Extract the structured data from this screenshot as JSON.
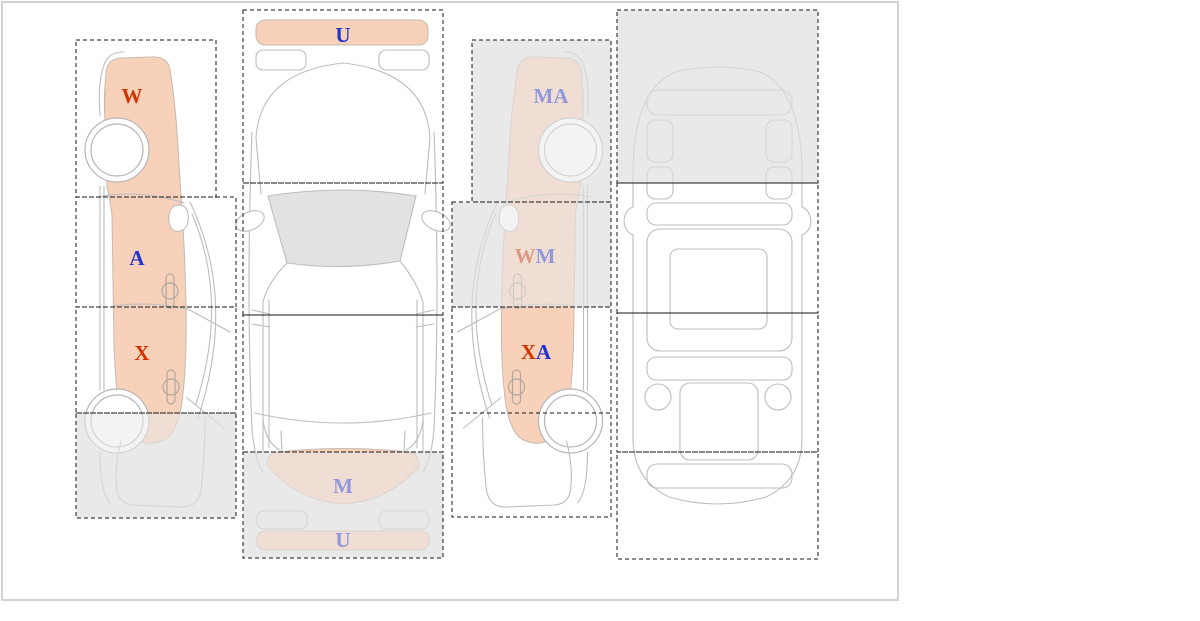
{
  "colors": {
    "red": "#d13300",
    "blue": "#2433cc",
    "highlight": "#f8d1ba",
    "zone_gray": "#e9e9e9",
    "outline_gray": "#bdbdbd",
    "glass_gray": "#e2e2e2",
    "dash_black": "#161616",
    "frame_border": "#d2d2d2"
  },
  "labels": {
    "left_fender": "W",
    "left_front_door": "A",
    "left_rear_door": "X",
    "top_front_bumper": "U",
    "top_rear_window": "M",
    "top_rear_bumper": "U",
    "right_fender": "MA",
    "right_front_door_1": "W",
    "right_front_door_2": "M",
    "right_rear_door_1": "X",
    "right_rear_door_2": "A"
  },
  "views": {
    "left_side": {
      "zones": [
        {
          "id": "fender",
          "label": "W",
          "label_color": "red",
          "shaded": false
        },
        {
          "id": "front_door",
          "label": "A",
          "label_color": "blue",
          "shaded": false
        },
        {
          "id": "rear_door",
          "label": "X",
          "label_color": "red",
          "shaded": false
        },
        {
          "id": "rear_quarter",
          "label": "",
          "shaded": true
        }
      ]
    },
    "top": {
      "zones": [
        {
          "id": "front",
          "label": "U",
          "label_color": "blue",
          "shaded": false
        },
        {
          "id": "windshield",
          "label": "",
          "shaded": false
        },
        {
          "id": "cabin",
          "label": "",
          "shaded": false
        },
        {
          "id": "rear",
          "label": "M / U",
          "label_color": "blue",
          "shaded": true
        }
      ]
    },
    "right_side": {
      "zones": [
        {
          "id": "fender",
          "label": "MA",
          "label_color": "blue",
          "shaded": true
        },
        {
          "id": "front_door",
          "label": "WM",
          "label_color": "red+blue",
          "shaded": true
        },
        {
          "id": "rear_door",
          "label": "XA",
          "label_color": "red+blue",
          "shaded": false
        },
        {
          "id": "rear_quarter",
          "label": "",
          "shaded": false
        }
      ]
    },
    "bottom": {
      "zones": [
        {
          "id": "front",
          "label": "",
          "shaded": true
        },
        {
          "id": "mid_front",
          "label": "",
          "shaded": false
        },
        {
          "id": "mid_rear",
          "label": "",
          "shaded": false
        },
        {
          "id": "rear",
          "label": "",
          "shaded": false
        }
      ]
    }
  }
}
